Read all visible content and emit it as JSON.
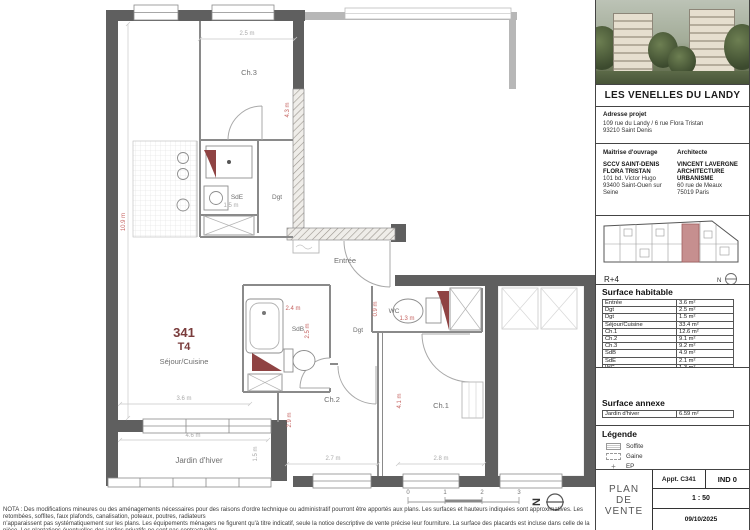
{
  "colors": {
    "wall_gray": "#5f5f5f",
    "accent_red": "#8f4343",
    "dim_red": "#c4625f"
  },
  "project": {
    "title": "LES VENELLES DU LANDY",
    "address_label": "Adresse projet",
    "address_line1": "109 rue du Landy / 6 rue Flora Tristan",
    "address_line2": "93210 Saint Denis",
    "owner_label": "Maîtrise d'ouvrage",
    "owner_name1": "SCCV SAINT-DENIS",
    "owner_name2": "FLORA TRISTAN",
    "owner_addr1": "101 bd. Victor Hugo",
    "owner_addr2": "93400 Saint-Ouen sur Seine",
    "architect_label": "Architecte",
    "architect_name1": "VINCENT LAVERGNE",
    "architect_name2": "ARCHITECTURE URBANISME",
    "architect_addr1": "60 rue de Meaux",
    "architect_addr2": "75019 Paris"
  },
  "level": {
    "label": "R+4",
    "north": "N"
  },
  "surface_habitable": {
    "title": "Surface habitable",
    "rows": [
      [
        "Entrée",
        "3.6 m²"
      ],
      [
        "Dgt",
        "2.5 m²"
      ],
      [
        "Dgt",
        "1.5 m²"
      ],
      [
        "Séjour/Cuisine",
        "33.4 m²"
      ],
      [
        "Ch.1",
        "12.6 m²"
      ],
      [
        "Ch.2",
        "9.1 m²"
      ],
      [
        "Ch.3",
        "9.2 m²"
      ],
      [
        "SdB",
        "4.9 m²"
      ],
      [
        "SdE",
        "2.1 m²"
      ],
      [
        "WC",
        "1.3 m²"
      ]
    ],
    "total_label": "Surface totale",
    "total_value": "80.2 m²"
  },
  "surface_annexe": {
    "title": "Surface annexe",
    "rows": [
      [
        "Jardin d'hiver",
        "6.59 m²"
      ]
    ]
  },
  "legend": {
    "title": "Légende",
    "soffite": "Soffite",
    "gaine": "Gaine",
    "ep": "EP"
  },
  "titleblock": {
    "doc_line1": "PLAN",
    "doc_line2": "DE",
    "doc_line3": "VENTE",
    "apt": "Appt. C341",
    "index": "IND 0",
    "scale": "1 : 50",
    "date": "09/10/2025"
  },
  "plan": {
    "unit_number": "341",
    "unit_type": "T4",
    "rooms": {
      "sejour": "Séjour/Cuisine",
      "entree": "Entrée",
      "ch1": "Ch.1",
      "ch2": "Ch.2",
      "ch3": "Ch.3",
      "sdb": "SdB",
      "sde": "SdE",
      "wc": "WC",
      "dgt1": "Dgt",
      "dgt2": "Dgt",
      "jardin": "Jardin d'hiver"
    },
    "dims": {
      "ch3_w": "2.5 m",
      "ch3_h": "4.3 m",
      "sejour_h": "10.9 m",
      "sejour_w": "3.6 m",
      "sde_w": "1.5 m",
      "sdb_w": "2.4 m",
      "sdb_h": "2.5 m",
      "wc_w": "1.3 m",
      "wc_h": "0.9 m",
      "ch2_w": "2.7 m",
      "ch2_h": "2.9 m",
      "ch1_w": "2.8 m",
      "ch1_h": "4.1 m",
      "jardin_w": "4.6 m",
      "jardin_h": "1.5 m"
    },
    "scale_ticks": [
      "0",
      "1",
      "2",
      "3"
    ],
    "north": "N"
  },
  "nota": {
    "line1": "NOTA : Des modifications mineures ou des aménagements nécessaires pour des raisons d'ordre technique ou administratif pourront être apportés aux plans. Les surfaces et hauteurs indiquées sont approximatives. Les retombées, soffites, faux plafonds, canalisation, poteaux, poutres, radiateurs",
    "line2": "n'apparaissent pas systématiquement sur les plans. Les équipements ménagers ne figurent qu'à titre indicatif, seule la notice descriptive de vente précise leur fourniture. La surface des placards est incluse dans celle de la pièce. Les plantations éventuelles des jardins privatifs ne sont pas contractuelles."
  }
}
